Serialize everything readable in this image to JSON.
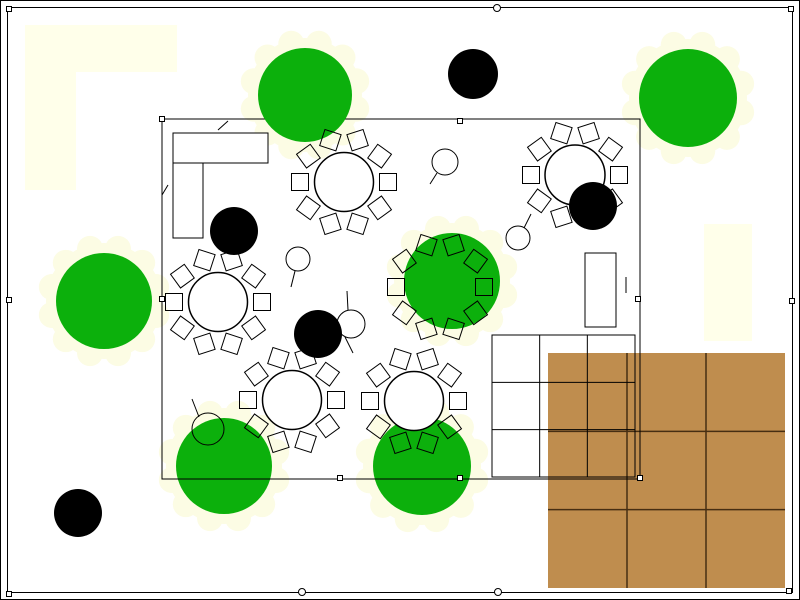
{
  "title": "banquet-site-plan",
  "canvas": {
    "width": 800,
    "height": 600,
    "background": "#FFFFFF"
  },
  "colors": {
    "line": "#000000",
    "tree_green": "#0CB00C",
    "deck_tan": "#BF8D4E",
    "deck_line": "#462E12",
    "cream": "#FFFFEA",
    "halo": "#FCFCE4",
    "white": "#FFFFFF"
  },
  "frame": {
    "outer": {
      "x": 0.5,
      "y": 0.5,
      "w": 799,
      "h": 599
    },
    "inner": {
      "x": 7.5,
      "y": 7.5,
      "w": 785,
      "h": 585
    }
  },
  "cream_areas": [
    {
      "x": 25,
      "y": 25,
      "w": 152,
      "h": 47
    },
    {
      "x": 25,
      "y": 72,
      "w": 51,
      "h": 118
    },
    {
      "x": 704,
      "y": 224,
      "w": 48,
      "h": 117
    }
  ],
  "venue": {
    "x": 162,
    "y": 119,
    "w": 478,
    "h": 360,
    "door_ticks": [
      [
        218,
        130,
        228,
        121
      ],
      [
        162,
        195,
        168,
        185
      ],
      [
        626,
        277,
        626,
        293
      ]
    ]
  },
  "counter": [
    {
      "x": 173,
      "y": 133,
      "w": 95,
      "h": 30
    },
    {
      "x": 173,
      "y": 163,
      "w": 30,
      "h": 75
    }
  ],
  "cabinet": {
    "x": 585,
    "y": 253,
    "w": 31,
    "h": 74
  },
  "white_grid": {
    "x": 492,
    "y": 335,
    "w": 143,
    "h": 142,
    "cols": 3,
    "rows": 3
  },
  "deck": {
    "x": 548,
    "y": 353,
    "w": 237,
    "h": 235,
    "cols": 3,
    "rows": 3
  },
  "tables": [
    {
      "cx": 344,
      "cy": 182,
      "r": 29.5,
      "chairs": 10,
      "chair_size": 17,
      "chair_dist": 44
    },
    {
      "cx": 218,
      "cy": 302,
      "r": 29.5,
      "chairs": 10,
      "chair_size": 17,
      "chair_dist": 44
    },
    {
      "cx": 575,
      "cy": 175,
      "r": 30,
      "chairs": 10,
      "chair_size": 17,
      "chair_dist": 44
    },
    {
      "cx": 440,
      "cy": 287,
      "r": 29.5,
      "chairs": 10,
      "chair_size": 17,
      "chair_dist": 44
    },
    {
      "cx": 292,
      "cy": 400,
      "r": 29.5,
      "chairs": 10,
      "chair_size": 17,
      "chair_dist": 44
    },
    {
      "cx": 414,
      "cy": 401,
      "r": 29.5,
      "chairs": 10,
      "chair_size": 17,
      "chair_dist": 44
    }
  ],
  "trees_under": [
    {
      "cx": 224,
      "cy": 466,
      "r": 48
    },
    {
      "cx": 422,
      "cy": 466,
      "r": 49
    }
  ],
  "trees_over": [
    {
      "cx": 305,
      "cy": 95,
      "r": 47
    },
    {
      "cx": 688,
      "cy": 98,
      "r": 49
    },
    {
      "cx": 104,
      "cy": 301,
      "r": 48
    },
    {
      "cx": 452,
      "cy": 281,
      "r": 48
    }
  ],
  "halo": {
    "base_extra": 10,
    "bump_r": 13,
    "bump_extra": 6,
    "bumps": 12,
    "offset_deg": 15
  },
  "black_circles": [
    {
      "cx": 473,
      "cy": 74,
      "r": 25
    },
    {
      "cx": 234,
      "cy": 231,
      "r": 24
    },
    {
      "cx": 318,
      "cy": 334,
      "r": 24
    },
    {
      "cx": 593,
      "cy": 206,
      "r": 24
    },
    {
      "cx": 78,
      "cy": 513,
      "r": 24
    }
  ],
  "mic_stands": [
    {
      "cx": 445,
      "cy": 162,
      "r": 13,
      "tails": [
        [
          437,
          173,
          430,
          184
        ]
      ]
    },
    {
      "cx": 298,
      "cy": 259,
      "r": 12,
      "tails": [
        [
          295,
          271,
          291,
          287
        ]
      ]
    },
    {
      "cx": 518,
      "cy": 238,
      "r": 12,
      "tails": [
        [
          524,
          228,
          531,
          214
        ]
      ]
    },
    {
      "cx": 351,
      "cy": 324,
      "r": 14,
      "tails": [
        [
          348,
          310,
          347,
          291
        ],
        [
          345,
          337,
          353,
          353
        ]
      ]
    },
    {
      "cx": 208,
      "cy": 429,
      "r": 16,
      "tails": [
        [
          199,
          417,
          192,
          399
        ]
      ]
    }
  ],
  "grips": [
    [
      9,
      9
    ],
    [
      791,
      9
    ],
    [
      9,
      300
    ],
    [
      792,
      301
    ],
    [
      9,
      594
    ],
    [
      789,
      591
    ],
    [
      162,
      119
    ],
    [
      640,
      478
    ],
    [
      460,
      121
    ],
    [
      340,
      478
    ],
    [
      460,
      478
    ],
    [
      638,
      299
    ],
    [
      162,
      299
    ]
  ],
  "circle_markers": [
    [
      497,
      8
    ],
    [
      302,
      592
    ],
    [
      498,
      592
    ]
  ]
}
